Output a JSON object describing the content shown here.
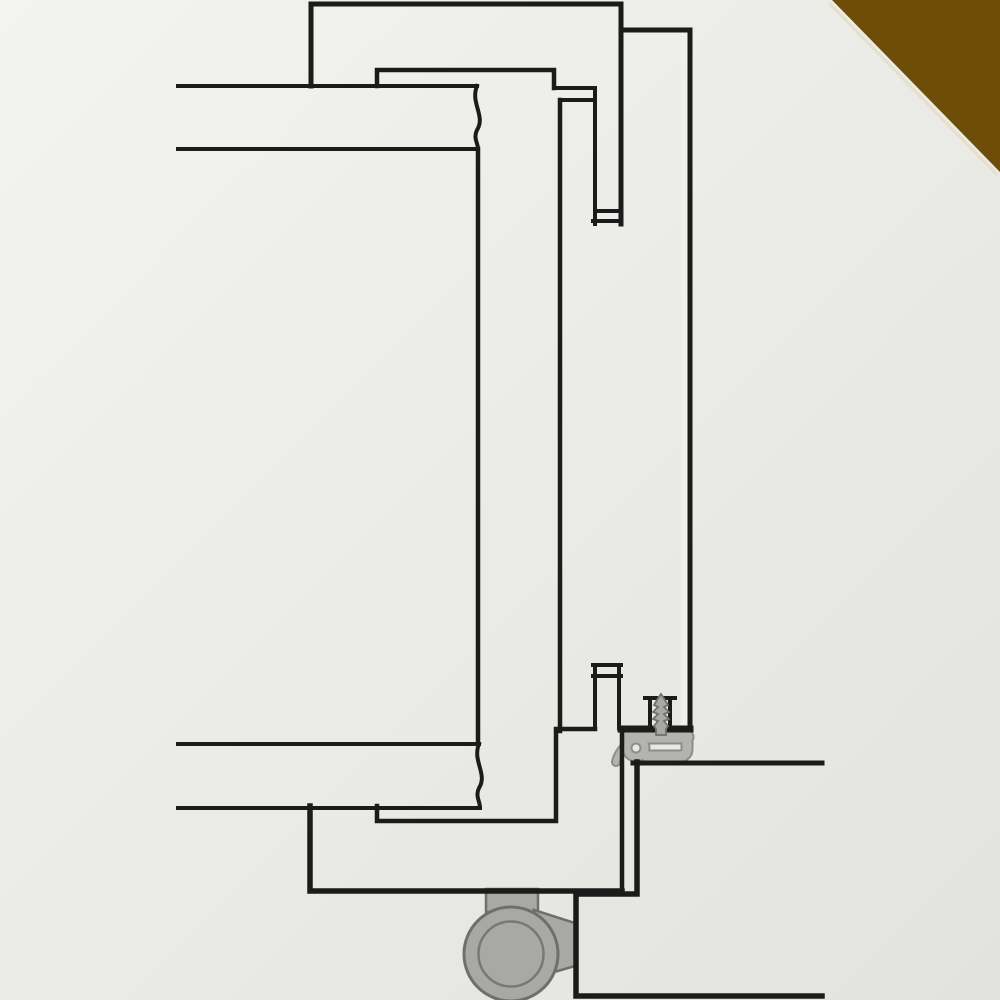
{
  "palette": {
    "ink": "#1b1b1b",
    "bg_light": "#f3f3ef",
    "bg_dark": "#e2e2de",
    "panel": "#e9e9e5",
    "panel_stripe": "#f0f0ec",
    "corner_brown": "#6d4d08",
    "corner_edge": "#e6e0ca",
    "gasket_body": "#b3b3b1",
    "gasket_edge": "#8c8c8a",
    "metal_body": "#a8a8a6",
    "metal_edge": "#6f6f6d",
    "metal_inner": "#787876"
  }
}
